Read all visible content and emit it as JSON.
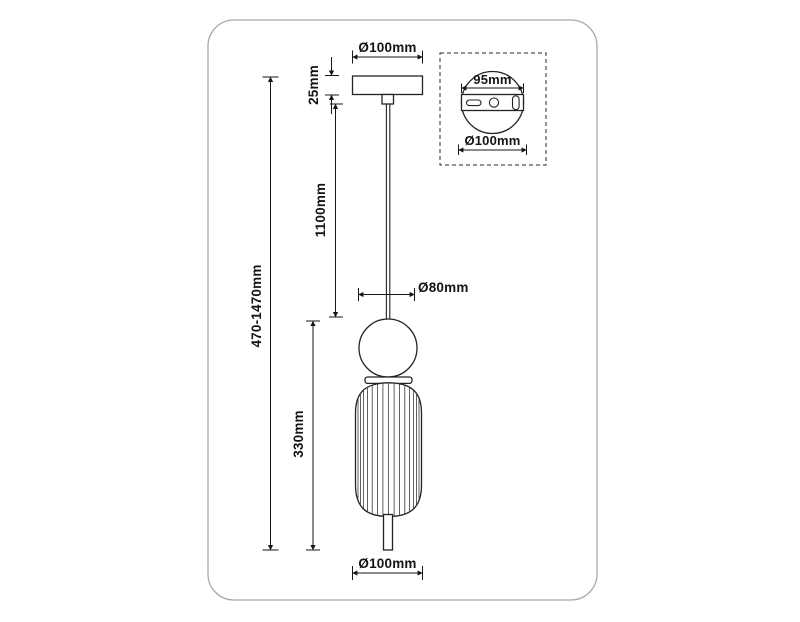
{
  "drawing": {
    "labels": {
      "canopy_diameter": "Ø100mm",
      "canopy_height": "25mm",
      "cable_length": "1100mm",
      "sphere_diameter": "Ø80mm",
      "shade_height": "330mm",
      "overall_height": "470-1470mm",
      "shade_diameter": "Ø100mm"
    },
    "mount_detail": {
      "hole_spacing": "95mm",
      "plate_diameter": "Ø100mm"
    },
    "colors": {
      "line": "#232323",
      "dimension": "#161616",
      "frame_border": "#a9a9a9",
      "background": "#ffffff"
    }
  }
}
